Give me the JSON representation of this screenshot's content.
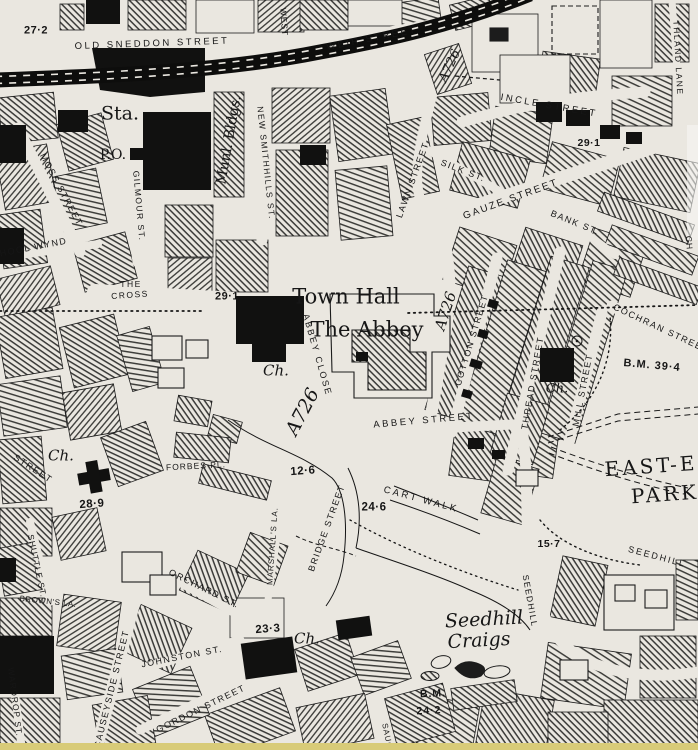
{
  "map": {
    "type": "historic-ordnance-survey-town-plan",
    "colors": {
      "paper": "#eae7e0",
      "ink": "#161616",
      "scan_edge": "#d8cb78"
    },
    "labels": [
      {
        "id": "spot-27-2",
        "text": "27·2",
        "x": 36,
        "y": 31,
        "rot": 0,
        "cls": "num",
        "fs": 11,
        "ls": 0.5
      },
      {
        "id": "old-sneddon-street",
        "text": "OLD SNEDDON STREET",
        "x": 152,
        "y": 44,
        "rot": -2,
        "cls": "sans",
        "fs": 9.5,
        "ls": 2.5
      },
      {
        "id": "weir-street",
        "text": "WEIR STREET",
        "x": 372,
        "y": 39,
        "rot": -11,
        "cls": "sans",
        "fs": 9.5,
        "ls": 2.5
      },
      {
        "id": "west-street",
        "text": "WEST",
        "x": 284,
        "y": 22,
        "rot": 86,
        "cls": "sans",
        "fs": 8.5,
        "ls": 1
      },
      {
        "id": "incle-street",
        "text": "INCLE STREET",
        "x": 549,
        "y": 106,
        "rot": 10,
        "cls": "sans",
        "fs": 9.5,
        "ls": 2.5
      },
      {
        "id": "thland-lane",
        "text": "THLAND LANE",
        "x": 678,
        "y": 58,
        "rot": 87,
        "cls": "sans",
        "fs": 8.5,
        "ls": 1.5
      },
      {
        "id": "station",
        "text": "Sta.",
        "x": 120,
        "y": 114,
        "rot": 0,
        "cls": "serif",
        "fs": 19,
        "ls": 0
      },
      {
        "id": "post-office",
        "text": "P.O.",
        "x": 113,
        "y": 155,
        "rot": 0,
        "cls": "serif",
        "fs": 14,
        "ls": 0
      },
      {
        "id": "municipal-buildings",
        "text": "Munl. Bldgs.",
        "x": 229,
        "y": 140,
        "rot": -80,
        "cls": "serif",
        "fs": 14,
        "ls": 0
      },
      {
        "id": "new-smithhills-street",
        "text": "NEW SMITHHILLS ST.",
        "x": 266,
        "y": 163,
        "rot": 84,
        "cls": "sans",
        "fs": 8.5,
        "ls": 1.5
      },
      {
        "id": "lawn-street",
        "text": "LAWN STREET",
        "x": 413,
        "y": 180,
        "rot": -70,
        "cls": "sans",
        "fs": 9,
        "ls": 1.5
      },
      {
        "id": "silk-street",
        "text": "SILK ST.",
        "x": 463,
        "y": 171,
        "rot": 21,
        "cls": "sans",
        "fs": 9,
        "ls": 1.5
      },
      {
        "id": "gauze-street",
        "text": "GAUZE STREET",
        "x": 511,
        "y": 200,
        "rot": -20,
        "cls": "sans",
        "fs": 10,
        "ls": 2
      },
      {
        "id": "bank-street",
        "text": "BANK ST.",
        "x": 575,
        "y": 223,
        "rot": 22,
        "cls": "sans",
        "fs": 9,
        "ls": 1.5
      },
      {
        "id": "spot-29-1-gauze",
        "text": "29·1",
        "x": 589,
        "y": 143,
        "rot": 0,
        "cls": "num",
        "fs": 10.5,
        "ls": 0.5
      },
      {
        "id": "moss-street",
        "text": "MOSS STREET",
        "x": 61,
        "y": 190,
        "rot": 62,
        "cls": "sans",
        "fs": 9,
        "ls": 1.5
      },
      {
        "id": "gilmour-street",
        "text": "GILMOUR ST.",
        "x": 139,
        "y": 206,
        "rot": 85,
        "cls": "sans",
        "fs": 8.5,
        "ls": 1.5
      },
      {
        "id": "school-wynd",
        "text": "SCHOOL WYND",
        "x": 26,
        "y": 249,
        "rot": -11,
        "cls": "sans",
        "fs": 9,
        "ls": 1.5
      },
      {
        "id": "the-cross-line1",
        "text": "THE",
        "x": 131,
        "y": 284,
        "rot": 0,
        "cls": "sans",
        "fs": 8.5,
        "ls": 1.5
      },
      {
        "id": "the-cross-line2",
        "text": "CROSS",
        "x": 130,
        "y": 295,
        "rot": -4,
        "cls": "sans",
        "fs": 8.5,
        "ls": 1.5
      },
      {
        "id": "spot-29-1-cross",
        "text": "29·1",
        "x": 227,
        "y": 297,
        "rot": 0,
        "cls": "num",
        "fs": 11,
        "ls": 0.5
      },
      {
        "id": "town-hall",
        "text": "Town Hall",
        "x": 346,
        "y": 297,
        "rot": 0,
        "cls": "serif",
        "fs": 21,
        "ls": 0
      },
      {
        "id": "the-abbey",
        "text": "The Abbey",
        "x": 367,
        "y": 330,
        "rot": 0,
        "cls": "serif",
        "fs": 21,
        "ls": 0
      },
      {
        "id": "a726-north",
        "text": "A726",
        "x": 450,
        "y": 66,
        "rot": -65,
        "cls": "seri",
        "fs": 13,
        "ls": 0
      },
      {
        "id": "a726-east",
        "text": "A726",
        "x": 446,
        "y": 311,
        "rot": -72,
        "cls": "seri",
        "fs": 15,
        "ls": 0
      },
      {
        "id": "abbey-close",
        "text": "ABBEY CLOSE",
        "x": 317,
        "y": 355,
        "rot": 74,
        "cls": "sans",
        "fs": 9,
        "ls": 2
      },
      {
        "id": "church-abbey-close",
        "text": "Ch.",
        "x": 276,
        "y": 371,
        "rot": 0,
        "cls": "seri",
        "fs": 15,
        "ls": 0
      },
      {
        "id": "a726-south",
        "text": "A726",
        "x": 303,
        "y": 412,
        "rot": -62,
        "cls": "seri",
        "fs": 19,
        "ls": 0
      },
      {
        "id": "abbey-street",
        "text": "ABBEY STREET",
        "x": 424,
        "y": 421,
        "rot": -5,
        "cls": "sans",
        "fs": 9.5,
        "ls": 2.5
      },
      {
        "id": "cotton-street",
        "text": "COTTON STREET",
        "x": 472,
        "y": 340,
        "rot": -73,
        "cls": "sans",
        "fs": 9,
        "ls": 1.5
      },
      {
        "id": "thread-street",
        "text": "THREAD STREET",
        "x": 533,
        "y": 383,
        "rot": -80,
        "cls": "sans",
        "fs": 9,
        "ls": 1.5
      },
      {
        "id": "mill-street",
        "text": "MILL STREET",
        "x": 583,
        "y": 390,
        "rot": -79,
        "cls": "sans",
        "fs": 9,
        "ls": 1.5
      },
      {
        "id": "cochran-street",
        "text": "COCHRAN STREET",
        "x": 661,
        "y": 329,
        "rot": 25,
        "cls": "sans",
        "fs": 9,
        "ls": 1.5
      },
      {
        "id": "bm-39-4",
        "text": "B.M. 39·4",
        "x": 652,
        "y": 366,
        "rot": 5,
        "cls": "num",
        "fs": 11,
        "ls": 1
      },
      {
        "id": "church-thread-street",
        "text": "Ch.",
        "x": 557,
        "y": 389,
        "rot": 0,
        "cls": "seri",
        "fs": 13,
        "ls": 0
      },
      {
        "id": "east-end-park-line1",
        "text": "EAST-E",
        "x": 651,
        "y": 466,
        "rot": -4,
        "cls": "serif",
        "fs": 20,
        "ls": 3
      },
      {
        "id": "east-end-park-line2",
        "text": "PARK",
        "x": 665,
        "y": 494,
        "rot": -4,
        "cls": "serif",
        "fs": 20,
        "ls": 3
      },
      {
        "id": "spot-15-7",
        "text": "15·7",
        "x": 549,
        "y": 544,
        "rot": 0,
        "cls": "num",
        "fs": 10.5,
        "ls": 0.5
      },
      {
        "id": "seedhill-road",
        "text": "SEEDHILL",
        "x": 657,
        "y": 557,
        "rot": 15,
        "cls": "sans",
        "fs": 9,
        "ls": 2
      },
      {
        "id": "seedhill-street",
        "text": "SEEDHILL",
        "x": 530,
        "y": 601,
        "rot": 80,
        "cls": "sans",
        "fs": 8.5,
        "ls": 1.5
      },
      {
        "id": "seedhill-craigs-line1",
        "text": "Seedhill",
        "x": 484,
        "y": 620,
        "rot": -3,
        "cls": "seri",
        "fs": 19,
        "ls": 0
      },
      {
        "id": "seedhill-craigs-line2",
        "text": "Craigs",
        "x": 479,
        "y": 641,
        "rot": -3,
        "cls": "seri",
        "fs": 19,
        "ls": 0
      },
      {
        "id": "forbes-place",
        "text": "FORBES PL.",
        "x": 196,
        "y": 466,
        "rot": -3,
        "cls": "sans",
        "fs": 8.5,
        "ls": 1
      },
      {
        "id": "spot-12-6",
        "text": "12·6",
        "x": 303,
        "y": 472,
        "rot": -4,
        "cls": "num",
        "fs": 11.5,
        "ls": 0.5
      },
      {
        "id": "spot-24-6",
        "text": "24·6",
        "x": 374,
        "y": 508,
        "rot": 0,
        "cls": "num",
        "fs": 11.5,
        "ls": 0.5
      },
      {
        "id": "cart-walk",
        "text": "CART WALK",
        "x": 421,
        "y": 500,
        "rot": 15,
        "cls": "sans",
        "fs": 9.5,
        "ls": 2.5
      },
      {
        "id": "bridge-street",
        "text": "BRIDGE STREET",
        "x": 327,
        "y": 528,
        "rot": -70,
        "cls": "sans",
        "fs": 9,
        "ls": 1.5
      },
      {
        "id": "marshalls-lane",
        "text": "MARSHALL'S LA.",
        "x": 273,
        "y": 546,
        "rot": -86,
        "cls": "sans",
        "fs": 8,
        "ls": 1
      },
      {
        "id": "orchard-street",
        "text": "ORCHARD ST.",
        "x": 204,
        "y": 589,
        "rot": 26,
        "cls": "sans",
        "fs": 9,
        "ls": 1.5
      },
      {
        "id": "johnston-street",
        "text": "JOHNSTON ST.",
        "x": 182,
        "y": 657,
        "rot": -11,
        "cls": "sans",
        "fs": 9,
        "ls": 1.5
      },
      {
        "id": "gordon-street",
        "text": "GORDON STREET",
        "x": 201,
        "y": 709,
        "rot": -26,
        "cls": "sans",
        "fs": 9,
        "ls": 1.5
      },
      {
        "id": "spot-23-3",
        "text": "23·3",
        "x": 268,
        "y": 630,
        "rot": -4,
        "cls": "num",
        "fs": 11.5,
        "ls": 0.5
      },
      {
        "id": "church-johnston-street",
        "text": "Ch.",
        "x": 307,
        "y": 639,
        "rot": 0,
        "cls": "seri",
        "fs": 15,
        "ls": 0
      },
      {
        "id": "bm-24-line1",
        "text": "B.M.",
        "x": 433,
        "y": 694,
        "rot": -3,
        "cls": "num",
        "fs": 10.5,
        "ls": 1
      },
      {
        "id": "bm-24-line2",
        "text": "24·2",
        "x": 429,
        "y": 711,
        "rot": -3,
        "cls": "num",
        "fs": 10.5,
        "ls": 1
      },
      {
        "id": "saucel-fragment",
        "text": "SAUCEL",
        "x": 388,
        "y": 742,
        "rot": 78,
        "cls": "sans",
        "fs": 8,
        "ls": 1
      },
      {
        "id": "shuttle-street",
        "text": "SHUTTLE ST.",
        "x": 37,
        "y": 566,
        "rot": 78,
        "cls": "sans",
        "fs": 8.5,
        "ls": 1
      },
      {
        "id": "causeyside-street",
        "text": "CAUSEYSIDE STREET",
        "x": 112,
        "y": 689,
        "rot": -76,
        "cls": "sans",
        "fs": 9,
        "ls": 1.5
      },
      {
        "id": "wardrop-street",
        "text": "WARDROP ST.",
        "x": 15,
        "y": 702,
        "rot": 83,
        "cls": "sans",
        "fs": 8.5,
        "ls": 1
      },
      {
        "id": "browns-lane",
        "text": "BROWN'S LA.",
        "x": 48,
        "y": 602,
        "rot": 6,
        "cls": "sans",
        "fs": 8,
        "ls": 0.5
      },
      {
        "id": "street-fragment-west",
        "text": "STREET",
        "x": 33,
        "y": 469,
        "rot": 33,
        "cls": "sans",
        "fs": 9,
        "ls": 1.5
      },
      {
        "id": "spot-28-9",
        "text": "28·9",
        "x": 92,
        "y": 505,
        "rot": -4,
        "cls": "num",
        "fs": 11.5,
        "ls": 0.5
      },
      {
        "id": "church-west",
        "text": "Ch.",
        "x": 61,
        "y": 456,
        "rot": 0,
        "cls": "seri",
        "fs": 15,
        "ls": 0
      },
      {
        "id": "lane-fragment-east",
        "text": "CH",
        "x": 689,
        "y": 243,
        "rot": 85,
        "cls": "sans",
        "fs": 8.5,
        "ls": 1
      }
    ]
  }
}
